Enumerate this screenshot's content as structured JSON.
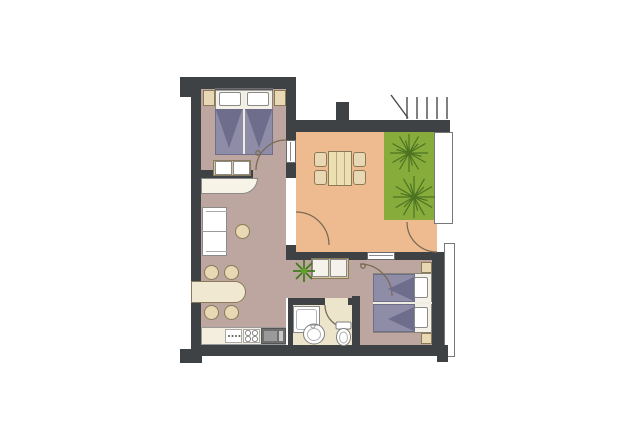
{
  "colors": {
    "wall": "#3e4245",
    "floor-main": "#bca69f",
    "floor-living": "#eebb90",
    "floor-bath": "#ece4cb",
    "terrace": "#88ac3c",
    "tree": "#4b7322",
    "plant": "#3c7a1b",
    "cream": "#e8d9b4",
    "cream-dark": "#d9c7a0",
    "cream-line": "#8a7a55",
    "blanket": "#8e8ca7",
    "blanket-dark": "#6f6d8c",
    "arc": "#7b6b56",
    "outline": "#8a8a8a"
  },
  "floorplan": {
    "rooms": [
      "bedroom-1",
      "living-dining-room",
      "terrace",
      "hallway",
      "kitchen",
      "bathroom",
      "bedroom-2"
    ],
    "furniture": [
      "double-bed",
      "nightstand",
      "bench",
      "curved-sideboard",
      "sofa",
      "side-table",
      "oval-dining-table-4-chairs",
      "square-dining-table-4-chairs",
      "kitchen-counter",
      "stove",
      "kitchen-sink",
      "shower",
      "washbasin",
      "toilet",
      "twin-beds",
      "potted-plant",
      "terrace-trees"
    ],
    "door_arcs": 5,
    "windows": 2
  }
}
